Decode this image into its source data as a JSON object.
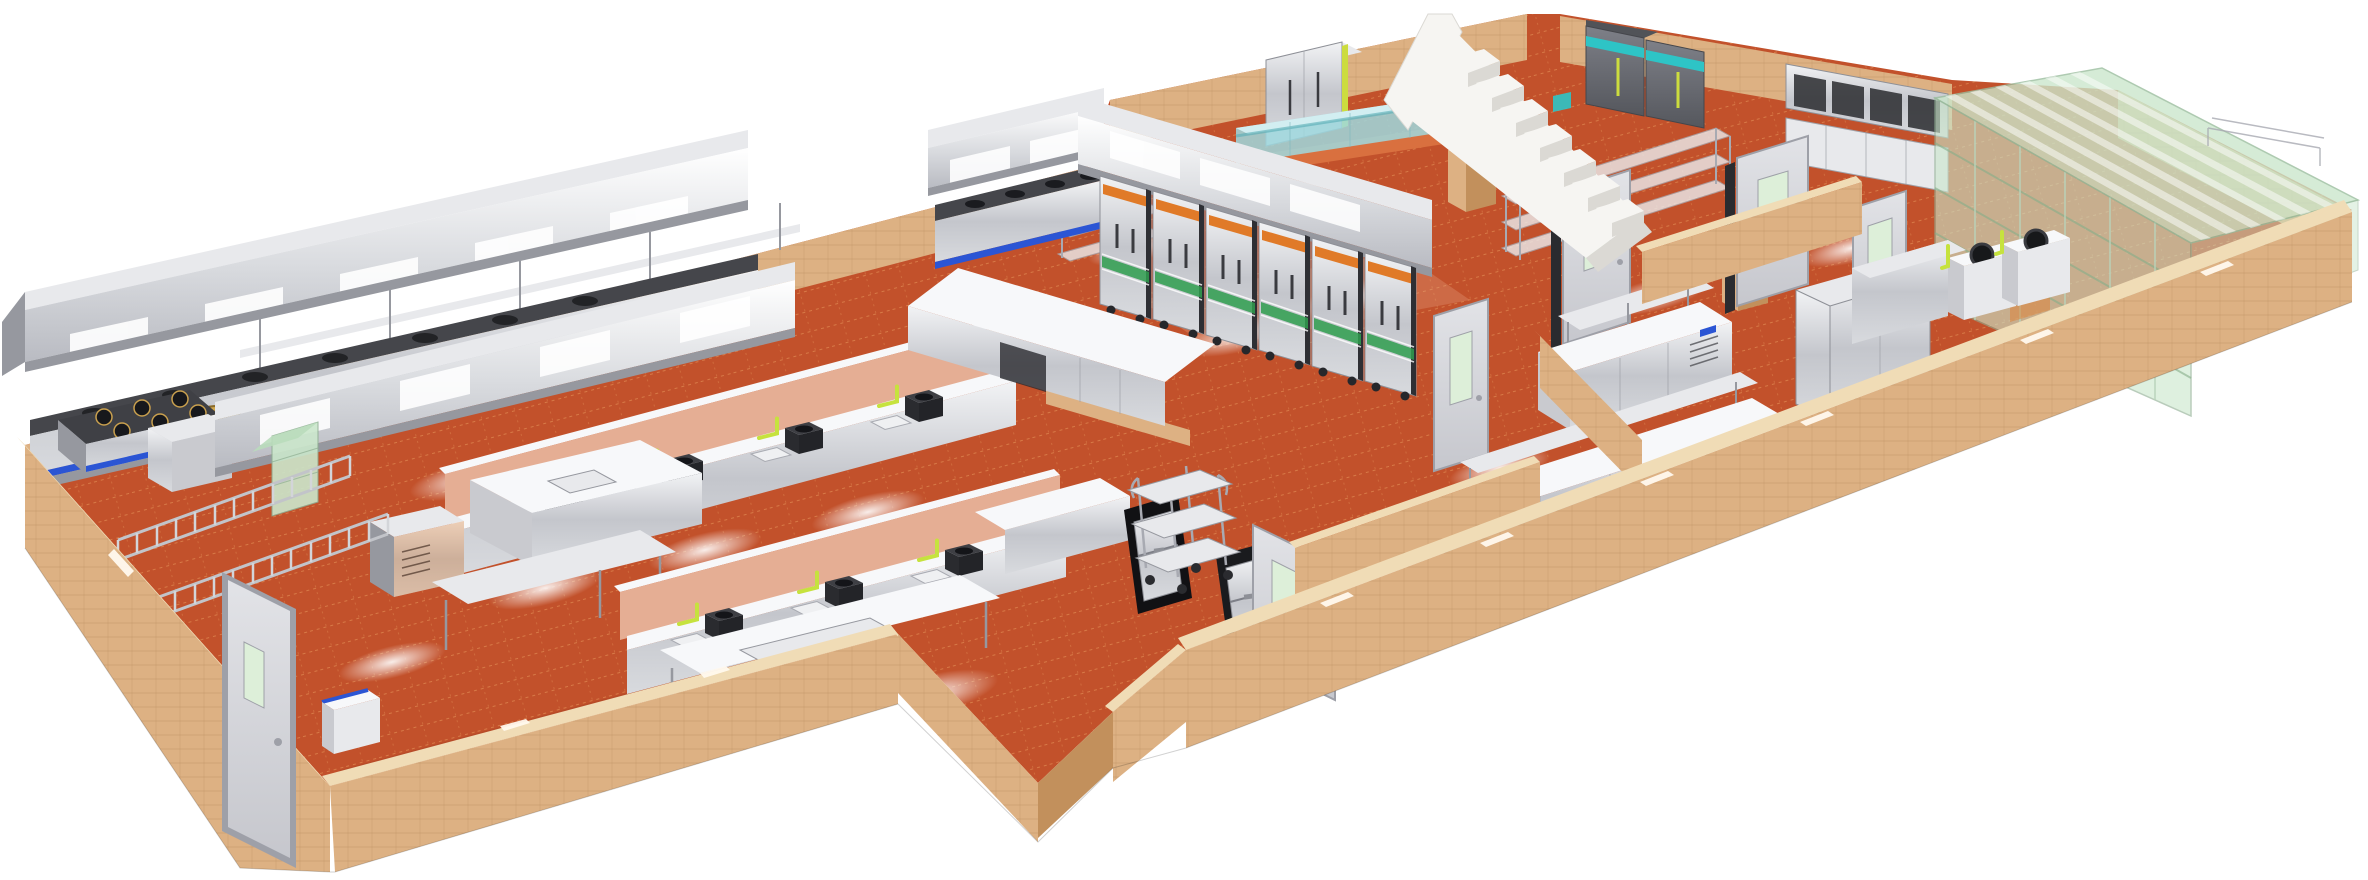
{
  "scene": {
    "subject": "3D isometric rendering of a commercial kitchen floor plan",
    "style": "photorealistic CAD cutaway render on white background, no visible text",
    "rooms": [
      "main cooking hall with twin hood lines",
      "central steamer cabinet line",
      "pass / lift notch with dumbwaiter hatches",
      "right service wing with prep rooms",
      "glass-walled cold room"
    ],
    "objects": [
      {
        "id": "exhaust-hood-main",
        "label": "long stainless exhaust hood over back cooking line"
      },
      {
        "id": "exhaust-hood-second",
        "label": "second stainless exhaust hood"
      },
      {
        "id": "stock-range-hood",
        "label": "short hood over stock-pot range"
      },
      {
        "id": "steamer-hood",
        "label": "large hood over steamer cabinets"
      },
      {
        "id": "cooking-line-main",
        "label": "wok/range cooking line with blue trim"
      },
      {
        "id": "six-burner-range",
        "label": "six-burner gas range"
      },
      {
        "id": "wok-ring",
        "label": "brass wok ring"
      },
      {
        "id": "wok-station-row-1",
        "label": "wok station row with lime gas pipes"
      },
      {
        "id": "wok-station-row-2",
        "label": "second wok station row"
      },
      {
        "id": "steamer-cabinet-line",
        "label": "steam cabinets with orange fascia and green ribbon"
      },
      {
        "id": "stock-pot-range",
        "label": "stock pot range with blue trim"
      },
      {
        "id": "pass-counter-l",
        "label": "L-shaped pass counter"
      },
      {
        "id": "prep-sink-table",
        "label": "prep table with sink"
      },
      {
        "id": "prep-table-front",
        "label": "front prep table"
      },
      {
        "id": "vented-undercounter-unit",
        "label": "vented under-counter refrigerator"
      },
      {
        "id": "pot-rack-ladders",
        "label": "ladder pot racks"
      },
      {
        "id": "green-glass-cabinet",
        "label": "glass display cabinet"
      },
      {
        "id": "service-podium",
        "label": "small service podium with blue edge"
      },
      {
        "id": "dumbwaiter-hatch-1",
        "label": "dumbwaiter lift hatch"
      },
      {
        "id": "dumbwaiter-hatch-2",
        "label": "dumbwaiter lift hatch"
      },
      {
        "id": "service-trolley",
        "label": "three-tier service trolley"
      },
      {
        "id": "upright-refrigerator-silver",
        "label": "two-door upright refrigerator"
      },
      {
        "id": "dark-refrigerators",
        "label": "gray refrigerators with teal stripe"
      },
      {
        "id": "wall-cabinet-bank",
        "label": "wall-hung cabinet bank"
      },
      {
        "id": "wire-shelving-rack",
        "label": "chrome wire shelving"
      },
      {
        "id": "fish-tank",
        "label": "long aquarium tank on orange ledge"
      },
      {
        "id": "staircase",
        "label": "white staircase"
      },
      {
        "id": "interior-door",
        "label": "gray interior door with vision panel"
      },
      {
        "id": "exterior-door",
        "label": "exterior door in west wall"
      },
      {
        "id": "worktable-overshelf-right",
        "label": "refrigerated worktable with overshelf"
      },
      {
        "id": "worktable-row-right",
        "label": "worktable row, right wing"
      },
      {
        "id": "silver-cabinet-block",
        "label": "tall silver cabinet block"
      },
      {
        "id": "corridor-counter",
        "label": "long corridor counter"
      },
      {
        "id": "glass-cold-room",
        "label": "green glass cold room with striped roof"
      },
      {
        "id": "stock-pot-stoves",
        "label": "stock pot stoves with black pots"
      },
      {
        "id": "outer-walls",
        "label": "tan tiled perimeter walls"
      },
      {
        "id": "floor",
        "label": "terracotta tile floor with light reflections"
      }
    ]
  },
  "colors": {
    "background": "#FFFFFF",
    "floor": "#C2512B",
    "floor_light": "#D9703F",
    "floor_grid": "#E89A5F",
    "floor_shadow": "#9E3E20",
    "wall_face": "#DDB183",
    "wall_top": "#F0DCB6",
    "wall_side": "#C2905C",
    "wall_grout": "#8A5A2A",
    "pink_panel": "#E5AE94",
    "steel": "#C9CACF",
    "steel_light": "#E8E9EC",
    "steel_dark": "#96989F",
    "steel_white": "#F7F8FA",
    "blue_trim": "#2B55D4",
    "teal_stripe": "#2EC4C6",
    "water": "#9FD8DE",
    "water_light": "#D2EEF1",
    "glass_green": "#CBE7CC",
    "glass_frame": "#8FAE92",
    "glass_line": "#86AE8A",
    "lime": "#C6E23E",
    "accent_orange": "#E07A28",
    "ribbon_green": "#2F9E4F",
    "stair_white": "#F6F5F2",
    "stair_shadow": "#DBD9D4",
    "door_face": "#D8D9DD",
    "door_frame": "#9EA0A8",
    "door_glass": "#DDEFD9",
    "dark_equipment": "#2A2B2F",
    "dark_mid": "#45464B",
    "fridge_dark": "#64666D",
    "gold": "#D2A84E"
  }
}
